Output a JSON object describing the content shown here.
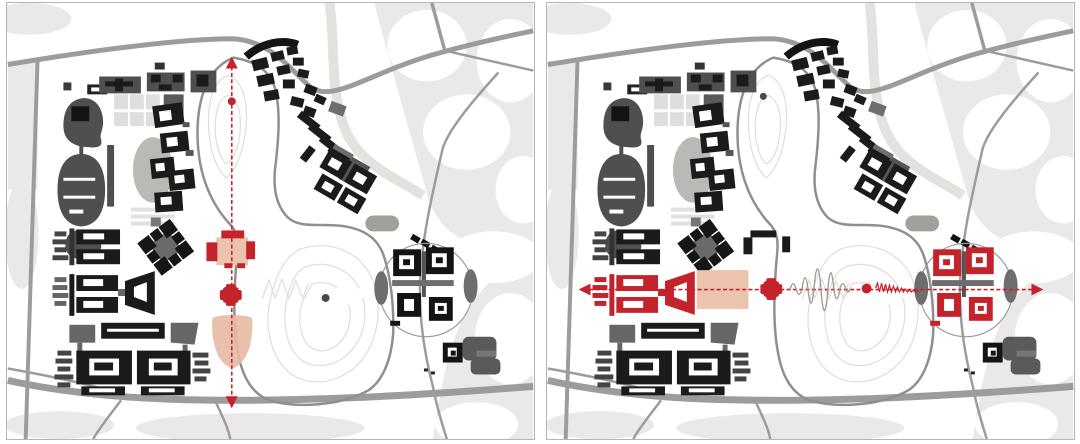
{
  "figure": {
    "description": "Two identical campus master-plan diagrams used for axis analysis: the left panel marks a vertical (north-south) red dashed axis through the central gate building and valley; the right panel marks a horizontal (east-west) red dashed axis linking the highlighted west teaching complex, a plaza, an oscillating terrain line over the hill, and the highlighted east round cluster.",
    "panels": [
      {
        "id": "left",
        "label": "Site plan with vertical north-south axis overlay",
        "axis": "vertical",
        "overlay_elements": [
          "axis-arrow-up",
          "axis-dashed-line",
          "axis-dot",
          "gate-building-highlight",
          "axis-node",
          "teardrop-plaza",
          "hill-peak-dot",
          "axis-arrow-down"
        ]
      },
      {
        "id": "right",
        "label": "Site plan with horizontal east-west axis overlay",
        "axis": "horizontal",
        "overlay_elements": [
          "axis-arrow-left",
          "axis-dashed-line",
          "highlighted-building-complex",
          "highlighted-plaza-rect",
          "axis-node",
          "terrain-wave-gray",
          "axis-dot",
          "terrain-wave-red",
          "east-cluster-highlight",
          "hill-peak-dot",
          "axis-arrow-right"
        ]
      }
    ]
  },
  "colors": {
    "accent_red": "#c4232b",
    "plaza_salmon": "#ecc3ad",
    "teardrop_salmon": "#e7b9a2",
    "building_black": "#1b1b1b",
    "building_dark_gray": "#4f4f4f",
    "building_mid_gray": "#6e6e6e",
    "track_gray": "#b9b9b6",
    "road_gray": "#9c9c9c",
    "loop_road_gray": "#8f8f8f",
    "park_gray": "#eae9e7",
    "contour_gray": "#deddd8",
    "wave_gray": "#a39a92",
    "panel_border": "#b5b5b3"
  }
}
